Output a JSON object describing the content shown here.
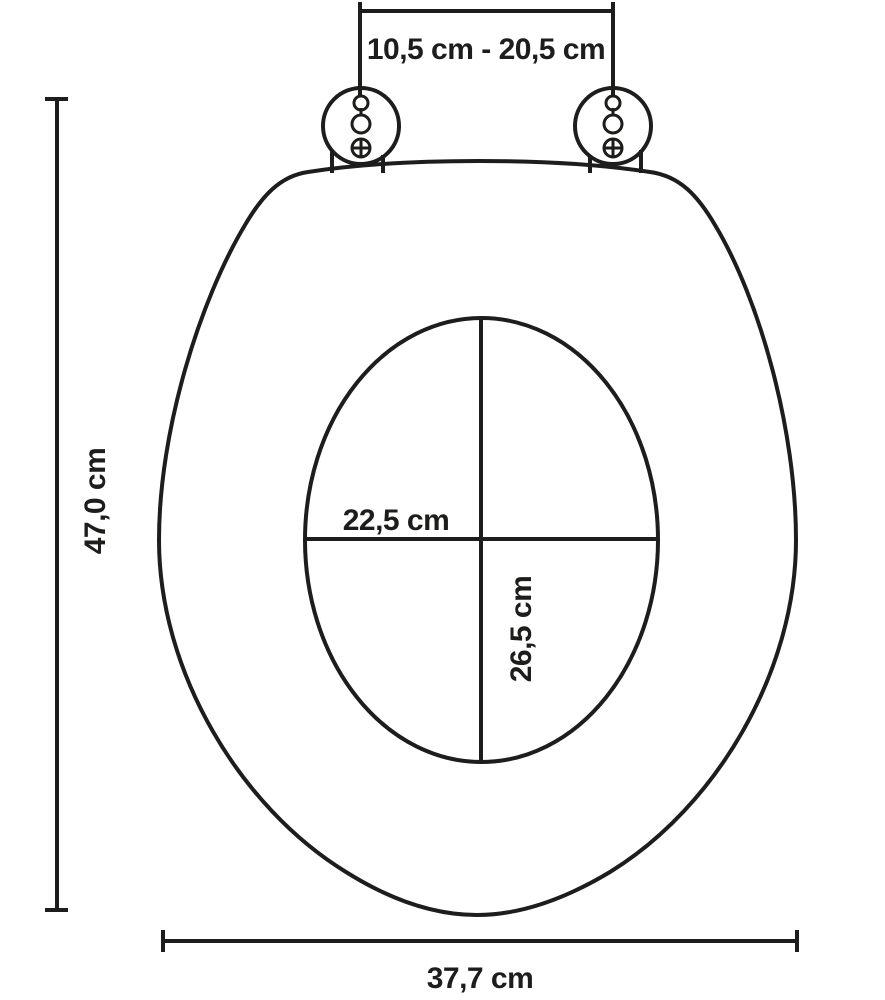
{
  "diagram": {
    "labels": {
      "hinge_span": "10,5 cm - 20,5 cm",
      "height": "47,0 cm",
      "inner_width": "22,5 cm",
      "inner_depth": "26,5 cm",
      "width": "37,7 cm"
    },
    "colors": {
      "line": "#1d1d1b",
      "background": "#ffffff"
    }
  }
}
